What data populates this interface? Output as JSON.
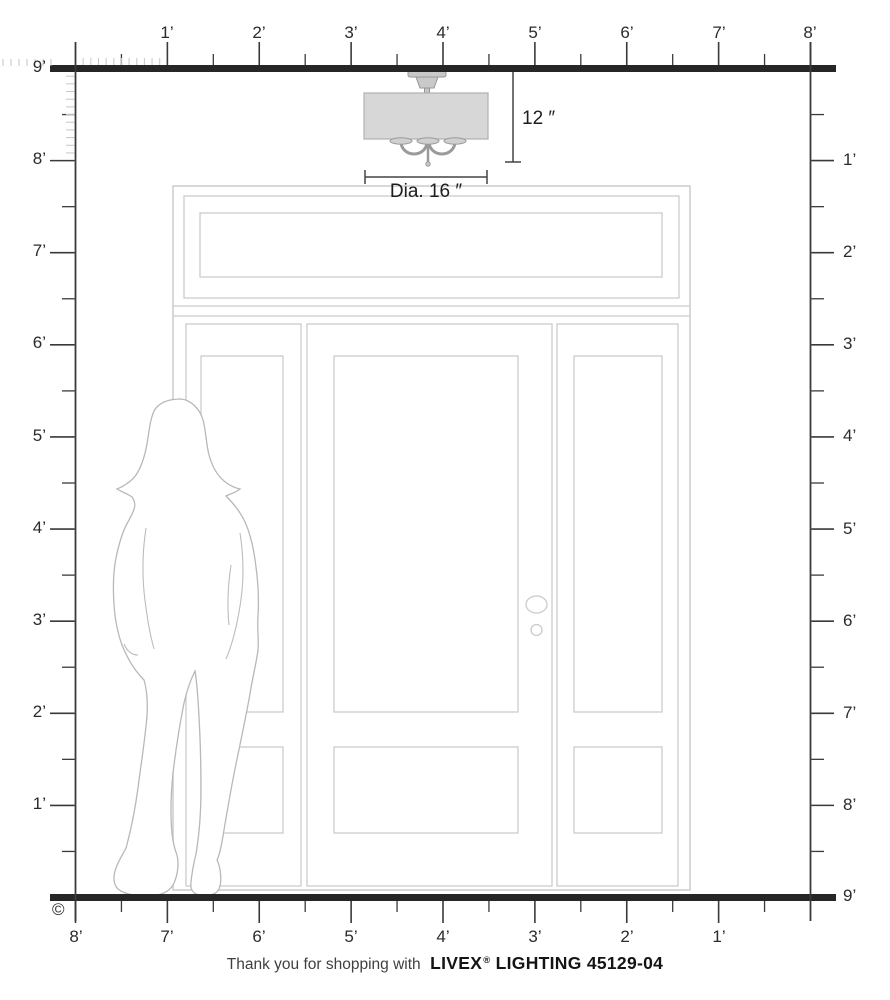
{
  "axes": {
    "top": {
      "labels": [
        "1’",
        "2’",
        "3’",
        "4’",
        "5’",
        "6’",
        "7’",
        "8’"
      ]
    },
    "left": {
      "labels": [
        "9’",
        "8’",
        "7’",
        "6’",
        "5’",
        "4’",
        "3’",
        "2’",
        "1’"
      ]
    },
    "right": {
      "labels": [
        "1’",
        "2’",
        "3’",
        "4’",
        "5’",
        "6’",
        "7’",
        "8’",
        "9’"
      ]
    },
    "bottom": {
      "labels": [
        "8’",
        "7’",
        "6’",
        "5’",
        "4’",
        "3’",
        "2’",
        "1’"
      ]
    }
  },
  "fixture": {
    "height_label": "12 ″",
    "diameter_label": "Dia. 16 ″"
  },
  "footer": {
    "prefix": "Thank you for shopping with",
    "brand": "LIVEX",
    "registered": "®",
    "suffix": "LIGHTING 45129-04"
  },
  "copyright_symbol": "©",
  "colors": {
    "heavy_line": "#262626",
    "axis_line": "#3a3a3a",
    "inch_tick": "#c6c6c6",
    "door_line": "#cbcbcb",
    "silhouette_line": "#b8b8b8",
    "shade_fill": "#d7d7d7",
    "metal_fill": "#c9c9c9"
  }
}
